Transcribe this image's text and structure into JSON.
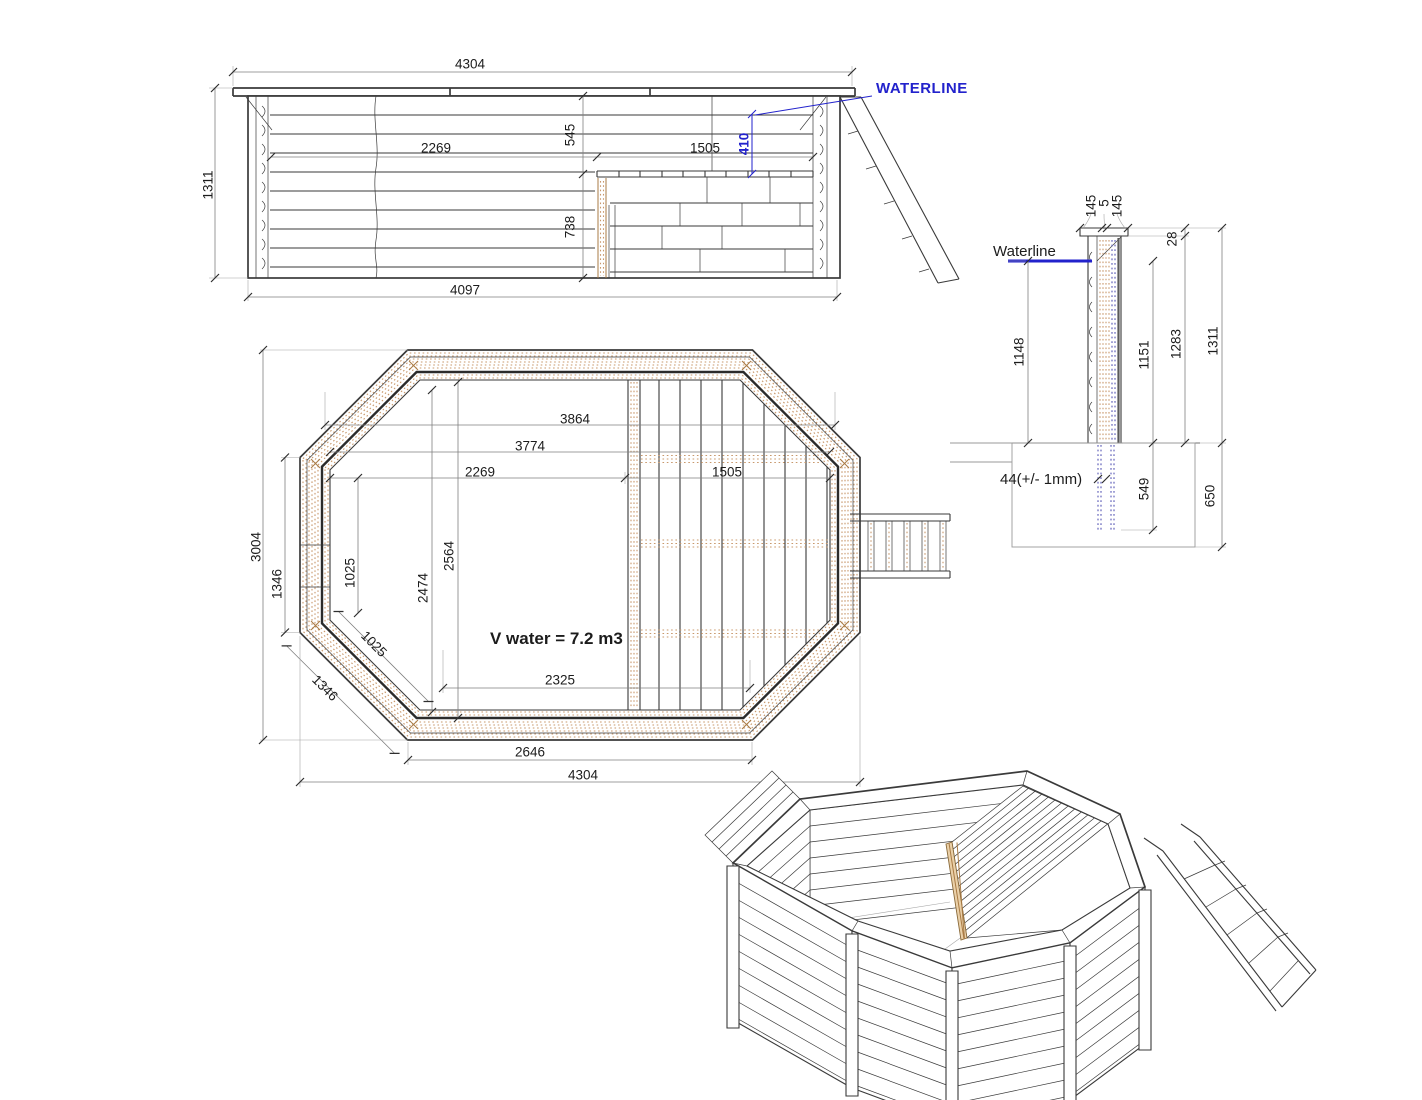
{
  "colors": {
    "line": "#3a3a3a",
    "dim_line": "#808080",
    "ext_line": "#a6a6a6",
    "dim_text": "#1c1c1c",
    "tan": "#c8986b",
    "tan_dark": "#a97b45",
    "blue": "#2222cc",
    "blue_dot": "#7070c0",
    "dark_ring": "#2b2b2b"
  },
  "elevation": {
    "waterline_label": "WATERLINE",
    "dim_overall_width": "4304",
    "dim_overall_height": "1311",
    "dim_base_width": "4097",
    "dim_water_area_width": "2269",
    "dim_rim_to_deck": "545",
    "dim_deck_width": "1505",
    "dim_waterline_above_deck": "410",
    "dim_deck_to_base": "738"
  },
  "section": {
    "waterline_label": "Waterline",
    "dim_cap_outer": "145",
    "dim_cap_gap": "5",
    "dim_cap_inner": "145",
    "dim_cap_thickness": "28",
    "dim_waterline_to_ground": "1148",
    "dim_wall_above_ground": "1151",
    "dim_top_to_ground": "1283",
    "dim_overall_height": "1311",
    "dim_post_embed_depth": "549",
    "dim_foundation_depth": "650",
    "tolerance_note": "44(+/- 1mm)"
  },
  "plan": {
    "dim_width_over_hatch": "3864",
    "dim_width_inner": "3774",
    "dim_water_width": "2269",
    "dim_deck_width": "1505",
    "dim_overall_depth": "3004",
    "dim_side_flat": "1346",
    "dim_side_inner": "1025",
    "dim_diag_inner": "1025",
    "dim_diag_flat": "1346",
    "dim_inner_depth_max": "2564",
    "dim_inner_depth": "2474",
    "volume_label": "V water = 7.2 m3",
    "dim_floor_width": "2325",
    "dim_bottom_flat": "2646",
    "dim_overall_width": "4304"
  }
}
